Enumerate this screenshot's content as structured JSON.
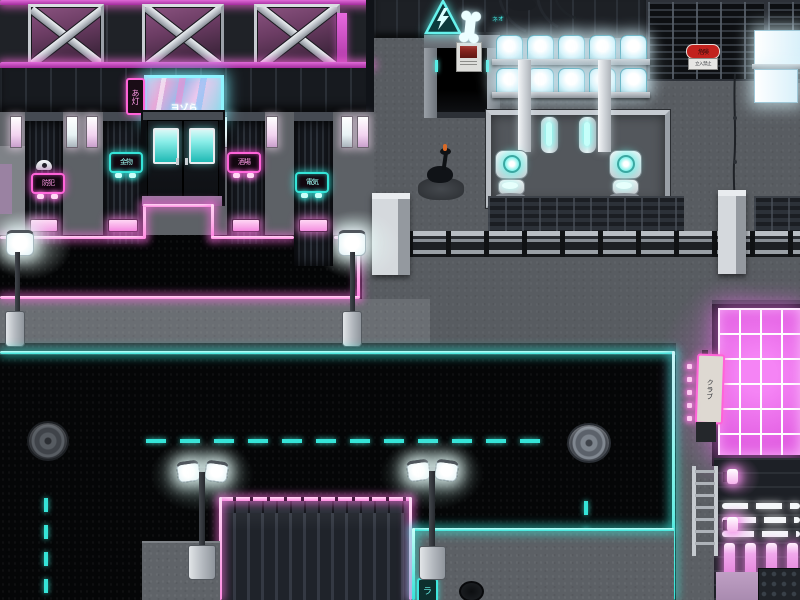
{
  "scene": {
    "description": "Top-down cyberpunk city street at night (tile-based game map)"
  },
  "colors": {
    "neon-pink": "#ff63d8",
    "neon-magenta": "#cf3ecf",
    "neon-cyan": "#35e4d8",
    "glow-white": "#f0fbff",
    "danger-red": "#c2221e",
    "window-pink": "#ea67e4"
  },
  "left_building": {
    "billboard": {
      "text": "ヨゾら"
    },
    "side_sign": {
      "text": "あ灯"
    },
    "shutter_signs": [
      {
        "text": "防犯",
        "color": "magenta"
      },
      {
        "text": "金物",
        "color": "cyan"
      },
      {
        "text": "酒場",
        "color": "magenta"
      },
      {
        "text": "電気",
        "color": "cyan"
      }
    ]
  },
  "industrial": {
    "hazard_triangle": {
      "icon": "lightning-bolt-icon"
    },
    "bone_sign": {
      "icon": "bone-icon"
    },
    "danger_sign": {
      "headline": "危険",
      "subtext": "立入禁止"
    },
    "graffiti": {
      "text": "ネオ"
    }
  },
  "street": {
    "pad_sign": {
      "text": "ラ"
    }
  },
  "right_building": {
    "club_sign": {
      "text": "クラブ"
    }
  }
}
